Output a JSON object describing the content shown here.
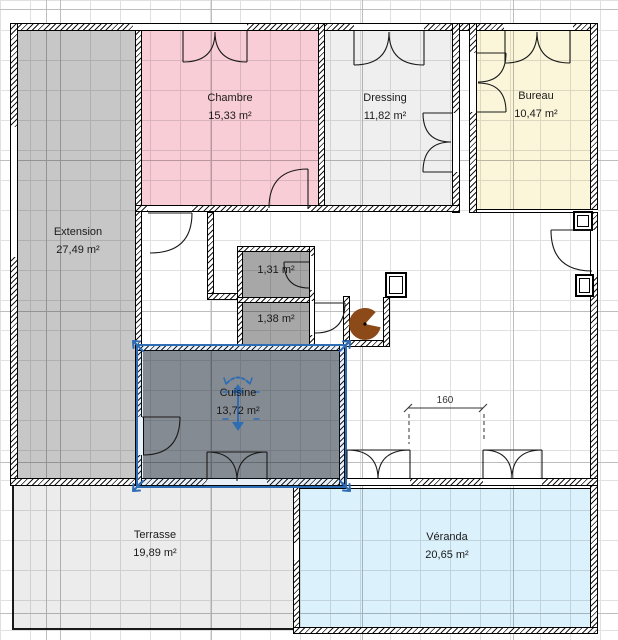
{
  "app": {
    "view": "floor-plan-editor"
  },
  "rooms": {
    "chambre": {
      "name": "Chambre",
      "area": "15,33 m²",
      "color": "#f9cdd6"
    },
    "dressing": {
      "name": "Dressing",
      "area": "11,82 m²",
      "color": "#efefef"
    },
    "bureau": {
      "name": "Bureau",
      "area": "10,47 m²",
      "color": "#fbf6da"
    },
    "extension": {
      "name": "Extension",
      "area": "27,49 m²",
      "color": "#c7c7c7"
    },
    "wc_small_1": {
      "name": "",
      "area": "1,31 m²",
      "color": "#a7a7a7"
    },
    "wc_small_2": {
      "name": "",
      "area": "1,38 m²",
      "color": "#a7a7a7"
    },
    "cuisine": {
      "name": "Cuisine",
      "area": "13,72 m²",
      "color": "#8f8f8f"
    },
    "terrasse": {
      "name": "Terrasse",
      "area": "19,89 m²",
      "color": "#ececec"
    },
    "veranda": {
      "name": "Véranda",
      "area": "20,65 m²",
      "color": "#dbf1fb"
    }
  },
  "dimension": {
    "label": "160"
  },
  "selection": {
    "selected_room": "Cuisine",
    "accent_color": "#2e6db4"
  },
  "furniture": {
    "round_object_color": "#8b4a17"
  }
}
